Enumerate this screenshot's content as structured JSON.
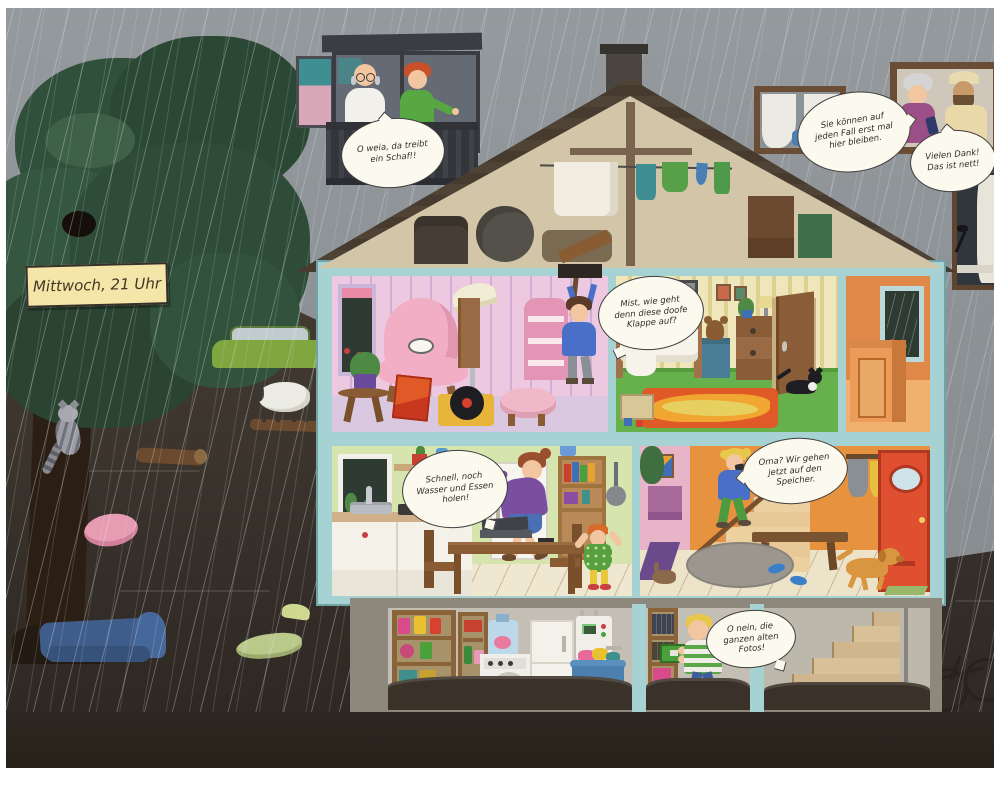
{
  "scene": {
    "kind": "picture-book illustration: cutaway house in a flood at night, raining",
    "note": {
      "text": "Mittwoch, 21 Uhr"
    },
    "speech_bubbles": [
      {
        "speaker": "boy-on-balcony",
        "text": "O weia, da treibt ein Schaf!!"
      },
      {
        "speaker": "neighbors-at-window",
        "text": "Sie können auf jeden Fall erst mal hier bleiben."
      },
      {
        "speaker": "grandma-at-window",
        "text": "Vielen Dank! Das ist nett!"
      },
      {
        "speaker": "girl-at-attic-hatch",
        "text": "Mist, wie geht denn diese doofe Klappe auf?"
      },
      {
        "speaker": "mother-in-kitchen",
        "text": "Schnell, noch Wasser und Essen holen!"
      },
      {
        "speaker": "girl-on-stairs",
        "text": "Oma? Wir gehen jetzt auf den Speicher."
      },
      {
        "speaker": "boy-in-cellar",
        "text": "O nein, die ganzen alten Fotos!"
      }
    ],
    "colors": {
      "sky": "#8b9194",
      "flood_water": "#453d33",
      "tree": "#31503b",
      "roof": "#473b2f",
      "house_frame": "#a7d2d3",
      "pink_room": "#ecc9e1",
      "bedroom_wall": "#efe6bb",
      "hall_orange": "#e6923f",
      "kitchen_wall": "#d6e5ae",
      "cellar_wall": "#c3bfb4",
      "front_door": "#df4f30",
      "bubble": "#fcf9ee",
      "note": "#f4e6a9"
    }
  }
}
